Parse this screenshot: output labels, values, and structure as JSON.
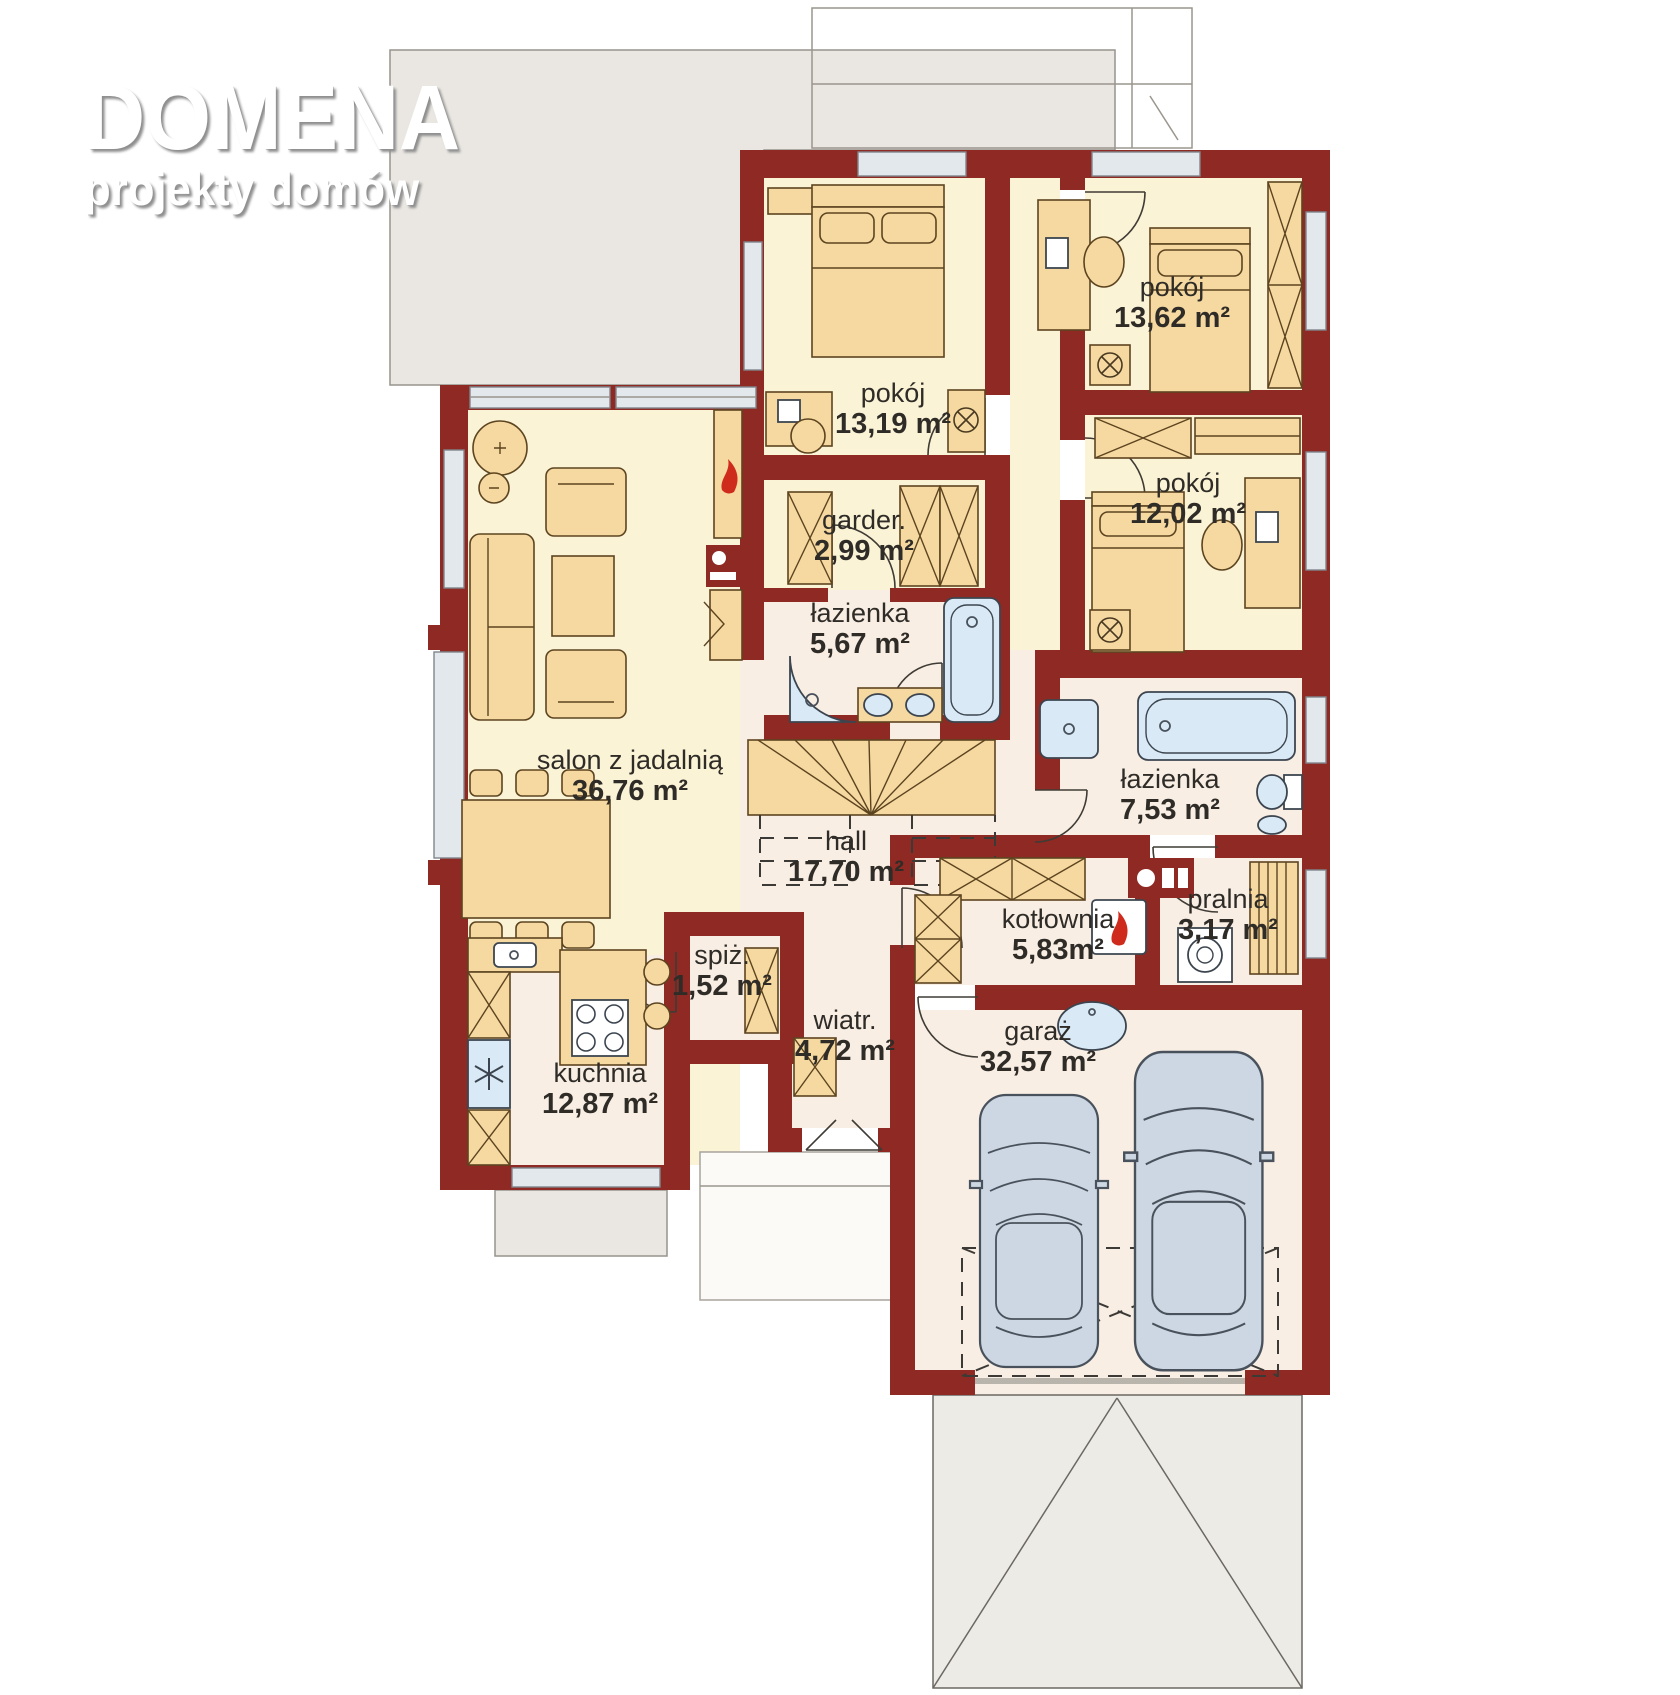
{
  "brand": {
    "name": "DOMENA",
    "tagline": "projekty domów"
  },
  "rooms": [
    {
      "key": "pokoj-1",
      "name": "pokój",
      "area": "13,19 m²"
    },
    {
      "key": "pokoj-2",
      "name": "pokój",
      "area": "13,62 m²"
    },
    {
      "key": "pokoj-3",
      "name": "pokój",
      "area": "12,02 m²"
    },
    {
      "key": "garderoba",
      "name": "garder.",
      "area": "2,99 m²"
    },
    {
      "key": "lazienka-1",
      "name": "łazienka",
      "area": "5,67 m²"
    },
    {
      "key": "salon",
      "name": "salon z jadalnią",
      "area": "36,76 m²"
    },
    {
      "key": "hall",
      "name": "hall",
      "area": "17,70 m²"
    },
    {
      "key": "lazienka-2",
      "name": "łazienka",
      "area": "7,53 m²"
    },
    {
      "key": "pralnia",
      "name": "pralnia",
      "area": "3,17 m²"
    },
    {
      "key": "kotlownia",
      "name": "kotłownia",
      "area": "5,83m²"
    },
    {
      "key": "spizarnia",
      "name": "spiż.",
      "area": "1,52 m²"
    },
    {
      "key": "wiatrolap",
      "name": "wiatr.",
      "area": "4,72 m²"
    },
    {
      "key": "kuchnia",
      "name": "kuchnia",
      "area": "12,87 m²"
    },
    {
      "key": "garaz",
      "name": "garaż",
      "area": "32,57 m²"
    }
  ],
  "colors": {
    "wall": "#8e2923",
    "room_warm": "#faf3d6",
    "room_light": "#f8eee4",
    "furniture": "#f5d9a0",
    "terrace": "#eae7e2",
    "fixture": "#d9eaf6",
    "car": "#ccd7e3",
    "flame": "#cf2b1c"
  }
}
